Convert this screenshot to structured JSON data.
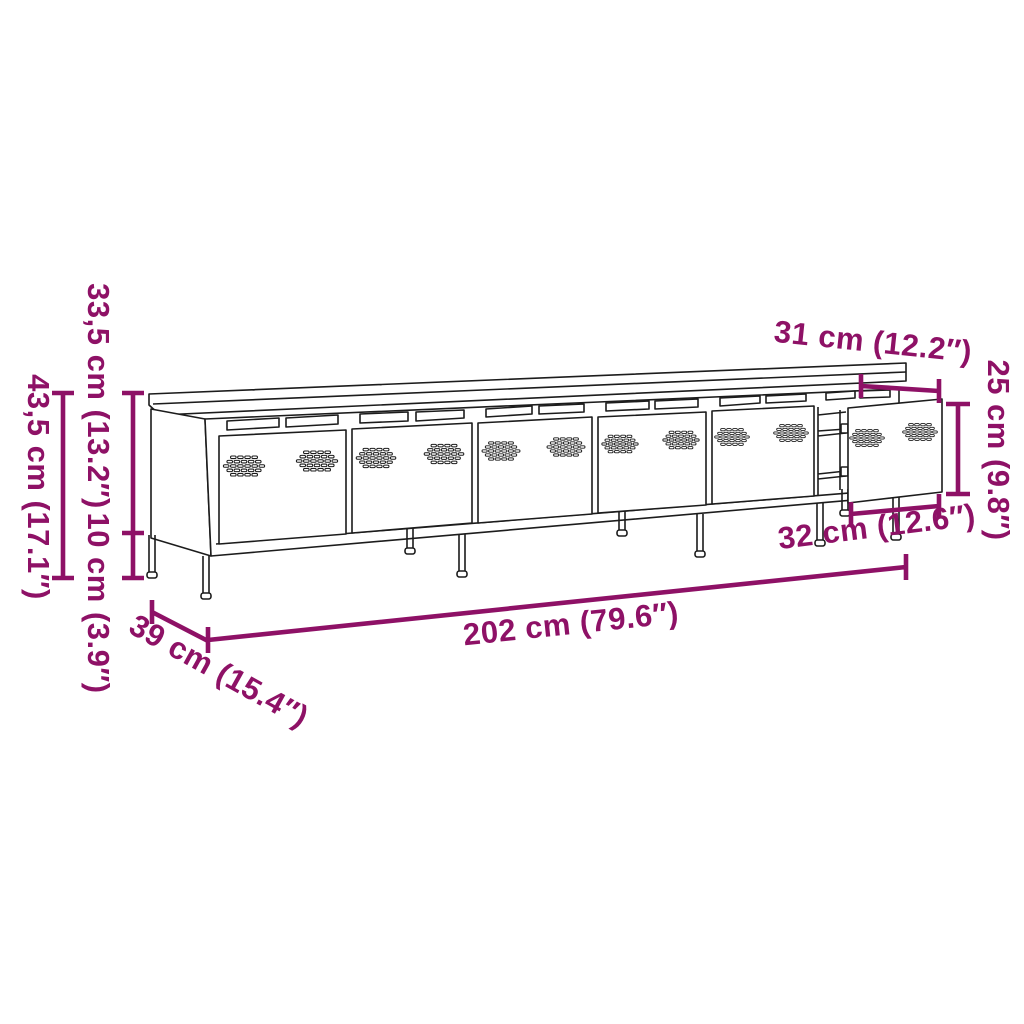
{
  "diagram": {
    "kind": "furniture-dimension-diagram",
    "subject": "TV cabinet with six perforated metal doors on legs, right door detached",
    "door_count": 6,
    "style": {
      "accent_color": "#8E1166",
      "line_color": "#1c1c1c",
      "background": "#ffffff"
    }
  },
  "labels": {
    "body_height": {
      "text": "33,5 cm (13.2″)",
      "cm": 33.5,
      "inch": 13.2
    },
    "leg_height": {
      "text": "10 cm (3.9″)",
      "cm": 10,
      "inch": 3.9
    },
    "total_height": {
      "text": "43,5 cm (17.1″)",
      "cm": 43.5,
      "inch": 17.1
    },
    "top_depth": {
      "text": "31 cm (12.2″)",
      "cm": 31,
      "inch": 12.2
    },
    "door_height": {
      "text": "25 cm (9.8″)",
      "cm": 25,
      "inch": 9.8
    },
    "door_width": {
      "text": "32 cm (12.6″)",
      "cm": 32,
      "inch": 12.6
    },
    "total_width": {
      "text": "202 cm (79.6″)",
      "cm": 202,
      "inch": 79.6
    },
    "total_depth": {
      "text": "39 cm (15.4″)",
      "cm": 39,
      "inch": 15.4
    }
  }
}
